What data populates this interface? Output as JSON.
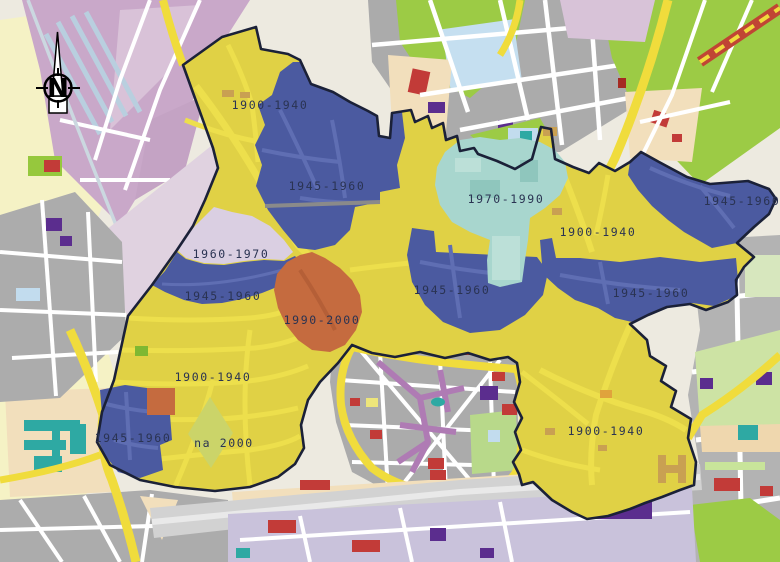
{
  "map": {
    "compass": {
      "label": "N"
    },
    "region_labels": [
      {
        "text": "1900-1940",
        "x": 270,
        "y": 105
      },
      {
        "text": "1945-1960",
        "x": 327,
        "y": 186
      },
      {
        "text": "1970-1990",
        "x": 506,
        "y": 199
      },
      {
        "text": "1900-1940",
        "x": 598,
        "y": 232
      },
      {
        "text": "1945-1960",
        "x": 742,
        "y": 201
      },
      {
        "text": "1960-1970",
        "x": 231,
        "y": 254
      },
      {
        "text": "1945-1960",
        "x": 223,
        "y": 296
      },
      {
        "text": "1945-1960",
        "x": 452,
        "y": 290
      },
      {
        "text": "1945-1960",
        "x": 651,
        "y": 293
      },
      {
        "text": "1990-2000",
        "x": 322,
        "y": 320
      },
      {
        "text": "1900-1940",
        "x": 213,
        "y": 377
      },
      {
        "text": "1945-1960",
        "x": 133,
        "y": 438
      },
      {
        "text": "na 2000",
        "x": 224,
        "y": 443
      },
      {
        "text": "1900-1940",
        "x": 606,
        "y": 431
      }
    ],
    "periods": [
      {
        "label": "1900-1940",
        "color": "#E0D145"
      },
      {
        "label": "1945-1960",
        "color": "#4B5AA0"
      },
      {
        "label": "1960-1970",
        "color": "#DACFE2"
      },
      {
        "label": "1970-1990",
        "color": "#A8D6CE"
      },
      {
        "label": "1990-2000",
        "color": "#C56B3F"
      },
      {
        "label": "na 2000",
        "color": "#CBD469"
      }
    ],
    "boundary_color": "#1B2138",
    "label_color": "#2A3352"
  }
}
